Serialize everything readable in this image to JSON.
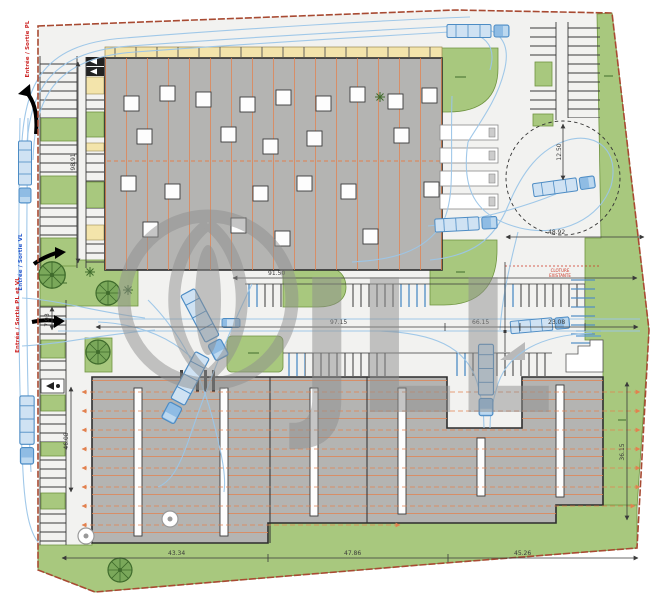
{
  "plan": {
    "watermark_text": "JLL",
    "entries": {
      "top_left": "Entrée / Sortie PL",
      "mid_left_vl": "Entrée / Sortie VL",
      "mid_left_pl_vl": "Entrée / Sortie PL et VL"
    },
    "notes": {
      "fence_line1": "CLOTURE",
      "fence_line2": "EXISTANTE"
    },
    "dimensions": {
      "left_parking_depth": "98.91",
      "north_parking_width": "91.50",
      "central_road_left": "97.15",
      "central_road_mid": "66.15",
      "central_road_right": "23.08",
      "road_width": "7.93",
      "southwest_aisle": "46.08",
      "south_1": "43.34",
      "south_2": "47.86",
      "south_3": "45.26",
      "east_building_depth": "36.15",
      "turning_area_width": "48.92",
      "turning_radius": "12.50"
    },
    "colors": {
      "landscape_green": "#a8c87e",
      "building_gray": "#b4b4b2",
      "canopy_yellow": "#f3e4ab",
      "grid_orange": "#e2814f",
      "truck_blue": "#5b9bd5",
      "boundary_red": "#a84a32",
      "watermark_gray": "#8f8f8f"
    }
  }
}
